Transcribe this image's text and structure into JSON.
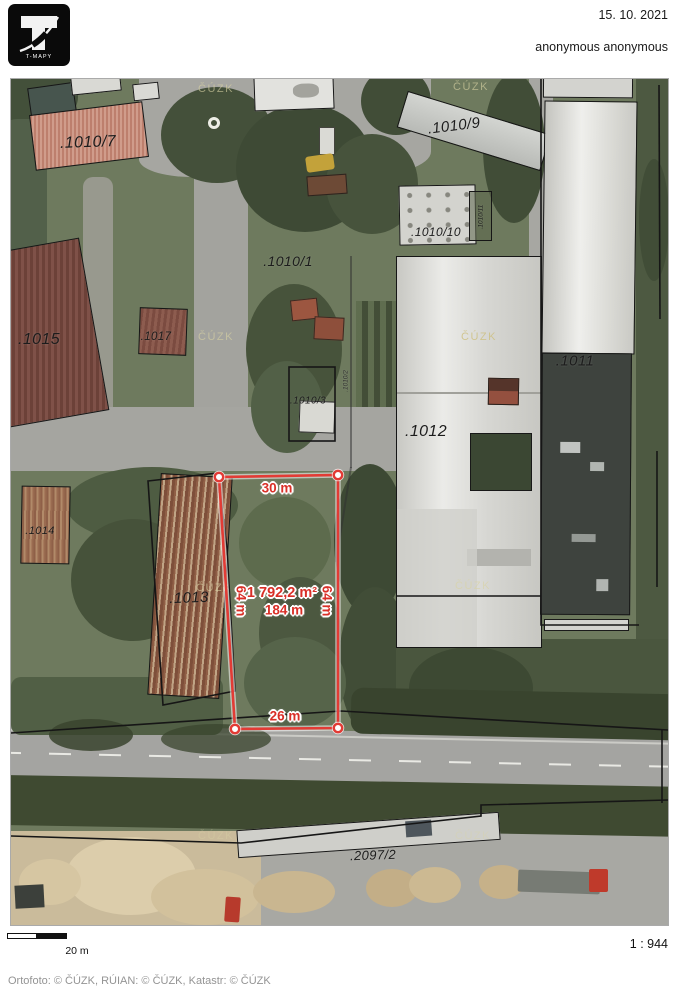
{
  "header": {
    "logo": "T-MAPY",
    "date": "15. 10. 2021",
    "user": "anonymous anonymous"
  },
  "map": {
    "watermark": "ČÚZK",
    "parcels": [
      {
        "text": ".1010/7"
      },
      {
        "text": ".1010/9"
      },
      {
        "text": ".1010/1"
      },
      {
        "text": ".1010/10"
      },
      {
        "text": ".1010/11"
      },
      {
        "text": ".1010/2"
      },
      {
        "text": ".1015"
      },
      {
        "text": ".1017"
      },
      {
        "text": ".1010/3"
      },
      {
        "text": ".1011"
      },
      {
        "text": ".1012"
      },
      {
        "text": ".1014"
      },
      {
        "text": ".1013"
      },
      {
        "text": ".2097/2"
      }
    ],
    "measurement": {
      "accent": "#e23b35",
      "width_top": "30 m",
      "width_bottom": "26 m",
      "side_left": "64 m",
      "side_right": "64 m",
      "area": "1 792,2 m²",
      "perimeter": "184 m"
    }
  },
  "footer": {
    "scale_bar_label": "20 m",
    "scale_ratio": "1 : 944",
    "attribution": "Ortofoto: © ČÚZK, RÚIAN: © ČÚZK, Katastr: © ČÚZK"
  }
}
